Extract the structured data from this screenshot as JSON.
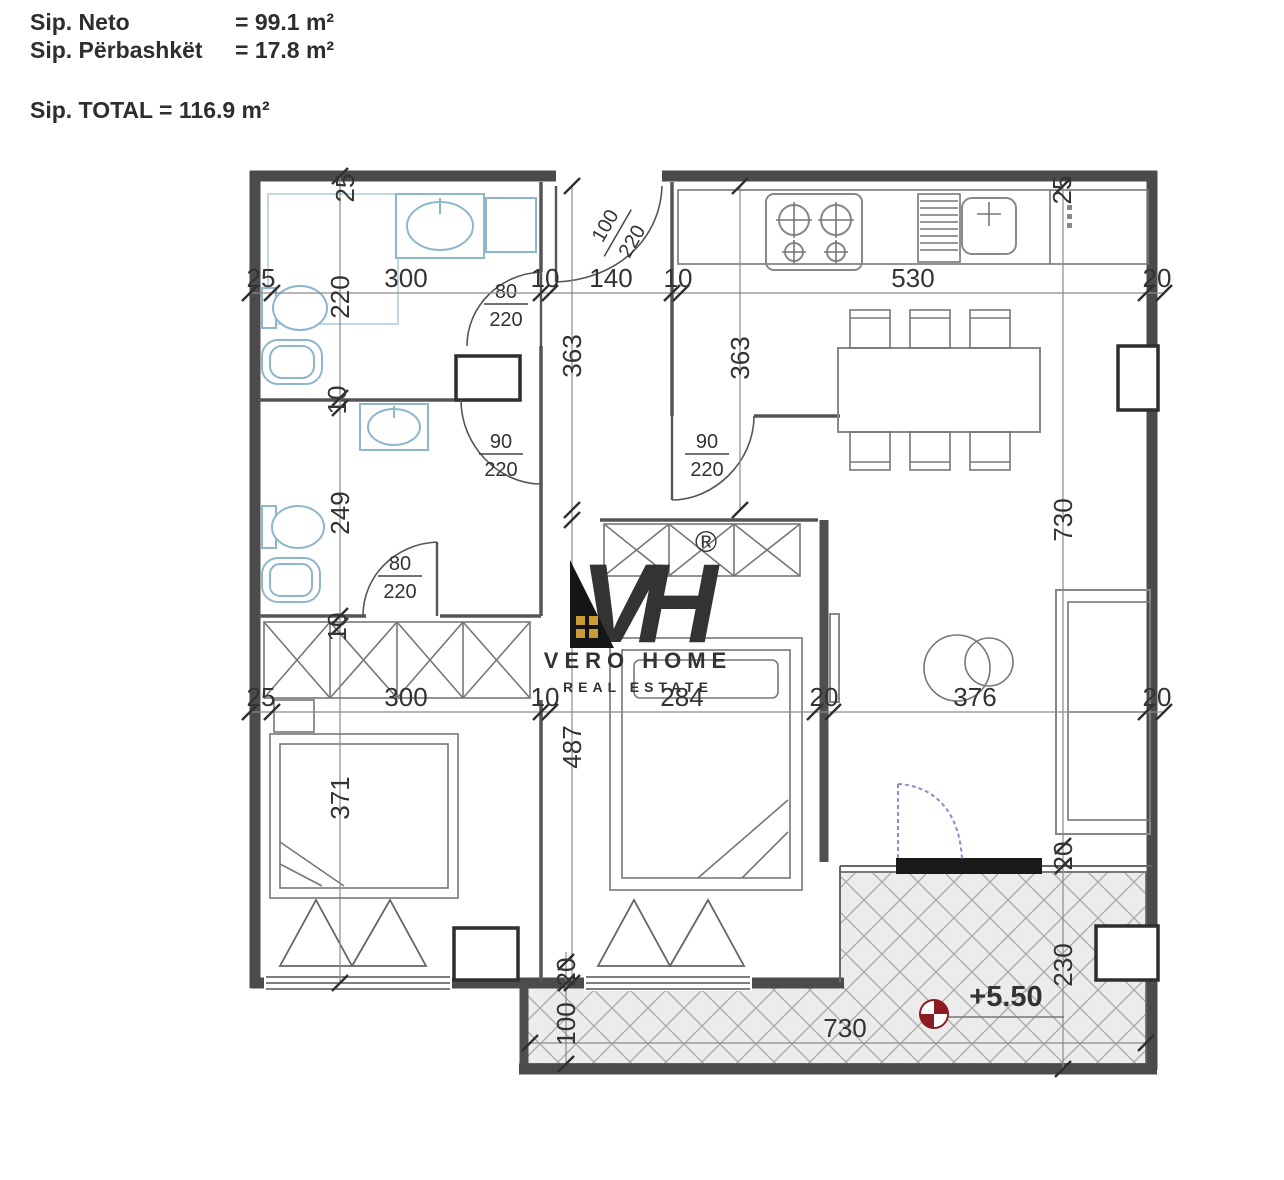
{
  "header": {
    "rows": [
      {
        "label": "Sip. Neto",
        "value": "= 99.1 m²"
      },
      {
        "label": "Sip. Përbashkët",
        "value": "= 17.8 m²"
      }
    ],
    "total": "Sip. TOTAL = 116.9 m²"
  },
  "logo": {
    "monogram": "VH",
    "registered": "®",
    "brand": "VERO HOME",
    "tagline": "REAL ESTATE"
  },
  "plan": {
    "dims": {
      "top": [
        "25",
        "300",
        "10",
        "140",
        "10",
        "530",
        "20"
      ],
      "mid": [
        "25",
        "300",
        "10",
        "284",
        "20",
        "376",
        "20"
      ],
      "wall_top_left": "25",
      "wall_top_right": "25",
      "left": [
        "220",
        "10",
        "249",
        "10",
        "371"
      ],
      "corridor": [
        "363",
        "487"
      ],
      "kitchen": "363",
      "right": [
        "730",
        "20",
        "230"
      ],
      "terrace": [
        "20",
        "100",
        "730"
      ]
    },
    "doors": [
      {
        "w": "100",
        "h": "220"
      },
      {
        "w": "80",
        "h": "220"
      },
      {
        "w": "90",
        "h": "220"
      },
      {
        "w": "90",
        "h": "220"
      },
      {
        "w": "80",
        "h": "220"
      }
    ],
    "elevation": {
      "value": "+5.50"
    },
    "colors": {
      "wall_gray": "#4b4b4b",
      "line_gray": "#666666",
      "fixture_blue": "#8FB6CC",
      "hatch_bg": "#ececec",
      "hatch_line": "#a8a8a8",
      "accent_gold": "#C99B35",
      "accent_gold_light": "#D9B458",
      "logo_black": "#151515",
      "elevation_red": "#8B1C24",
      "door_swing_blue": "#8890CC",
      "sill_black": "#1a1a1a"
    }
  }
}
